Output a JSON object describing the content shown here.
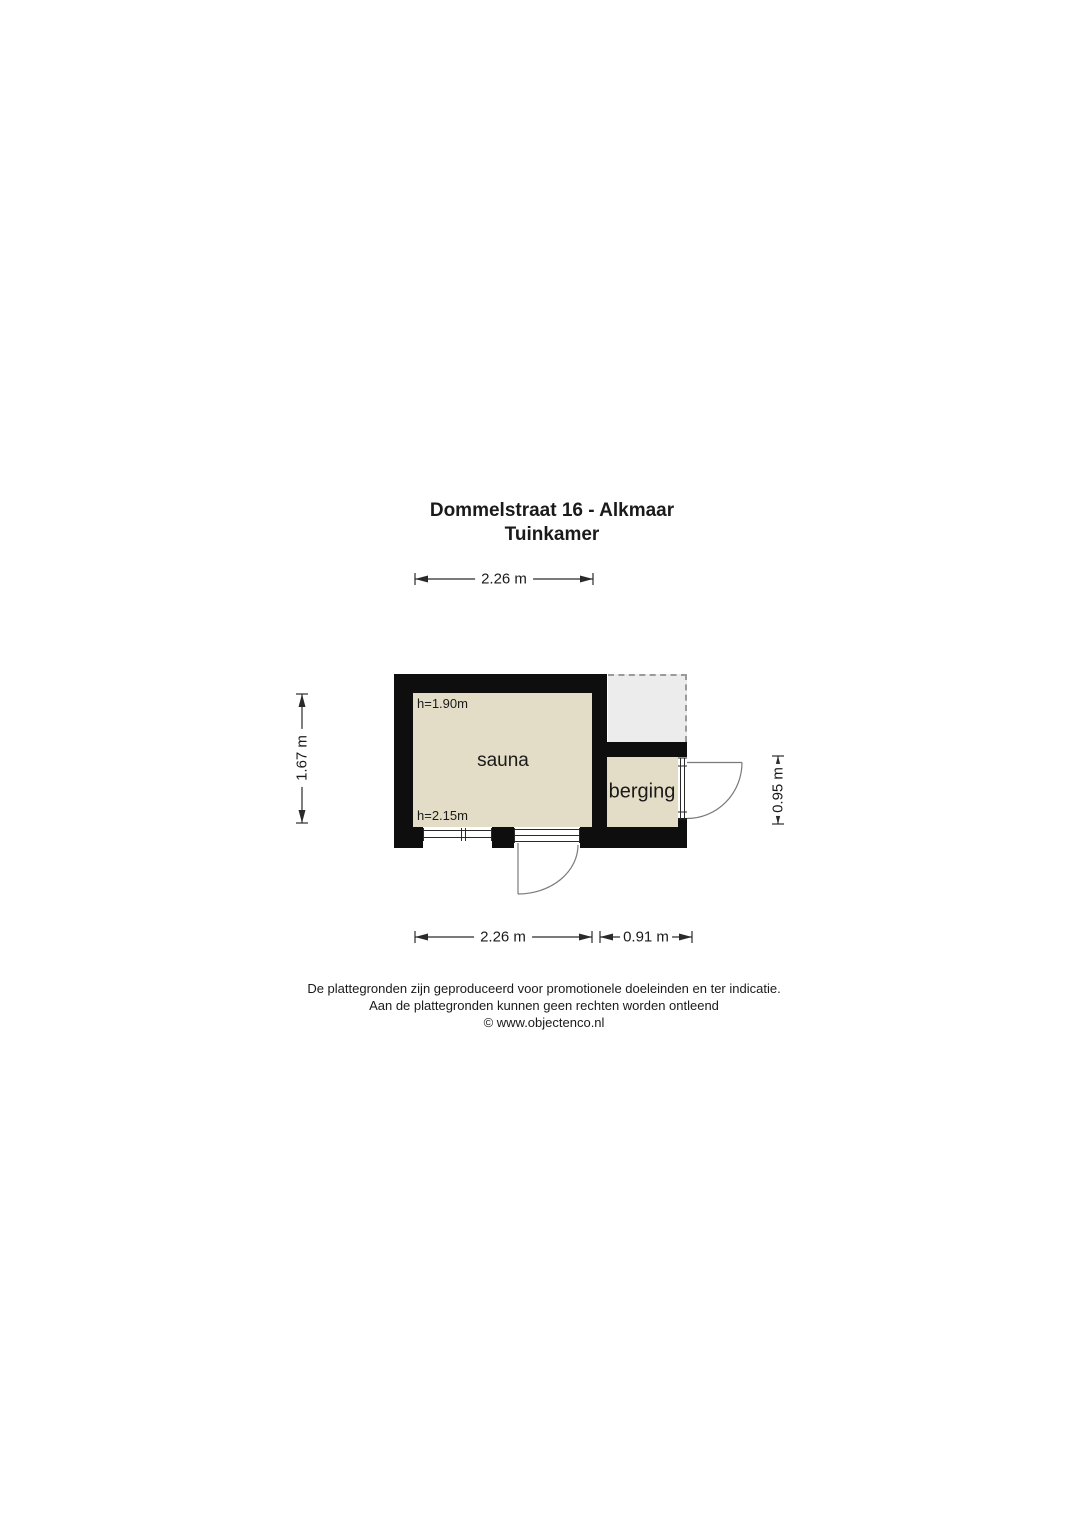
{
  "title": {
    "line1": "Dommelstraat 16 - Alkmaar",
    "line2": "Tuinkamer"
  },
  "plan": {
    "rooms": {
      "sauna": {
        "label": "sauna",
        "ceiling_height_top": "h=1.90m",
        "ceiling_height_bottom": "h=2.15m"
      },
      "berging": {
        "label": "berging"
      }
    },
    "dimensions": {
      "top_width": "2.26 m",
      "left_height": "1.67 m",
      "right_height": "0.95 m",
      "bottom_width_sauna": "2.26 m",
      "bottom_width_berging": "0.91 m"
    }
  },
  "footer": {
    "line1": "De plattegronden zijn geproduceerd voor promotionele doeleinden en ter indicatie.",
    "line2": "Aan de plattegronden kunnen geen rechten worden ontleend",
    "line3": "© www.objectenco.nl"
  },
  "colors": {
    "wall": "#0e0e0e",
    "room_fill": "#e3dcc6",
    "canopy_fill": "#ececec",
    "canopy_border": "#9a9a9a",
    "line": "#2a2a2a",
    "door_line": "#7a7a7a",
    "text": "#1a1a1a"
  }
}
